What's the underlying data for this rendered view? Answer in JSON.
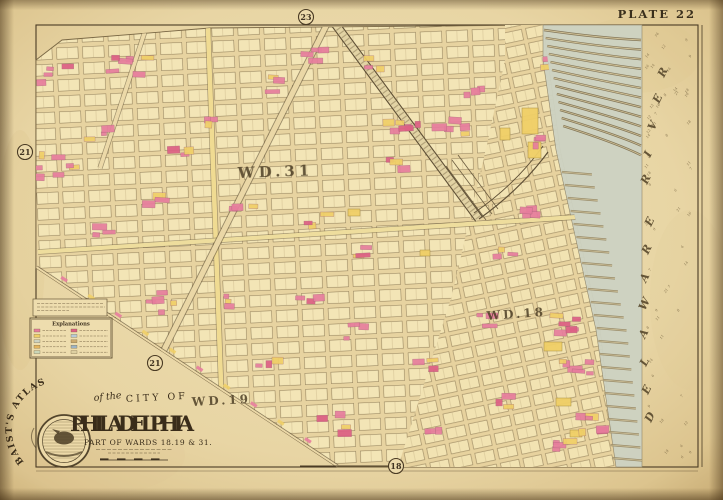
{
  "plate": {
    "label": "PLATE 22"
  },
  "refs": {
    "top": "23",
    "left": "21",
    "center": "21",
    "bottom": "18"
  },
  "wards": {
    "w31": "WD.31",
    "w18": "WD.18",
    "w19": "WD.19"
  },
  "river": {
    "name": "DELAWARE RIVER"
  },
  "cartouche": {
    "atlas": "BAIST'S ATLAS",
    "of_the": "of the",
    "city_of": "CITY OF",
    "city": "PHILADELPHIA",
    "subtitle": "PART OF WARDS 18.19 & 31."
  },
  "legend": {
    "title": "Explanations"
  },
  "colors": {
    "paper": "#e8d5a4",
    "block": "#f3e5b6",
    "street": "#e7d3a0",
    "pink": "#e77d9d",
    "deep_pink": "#dd5f84",
    "yellow": "#f0cf67",
    "water": "#cdd2c2",
    "ink": "#43351f"
  }
}
